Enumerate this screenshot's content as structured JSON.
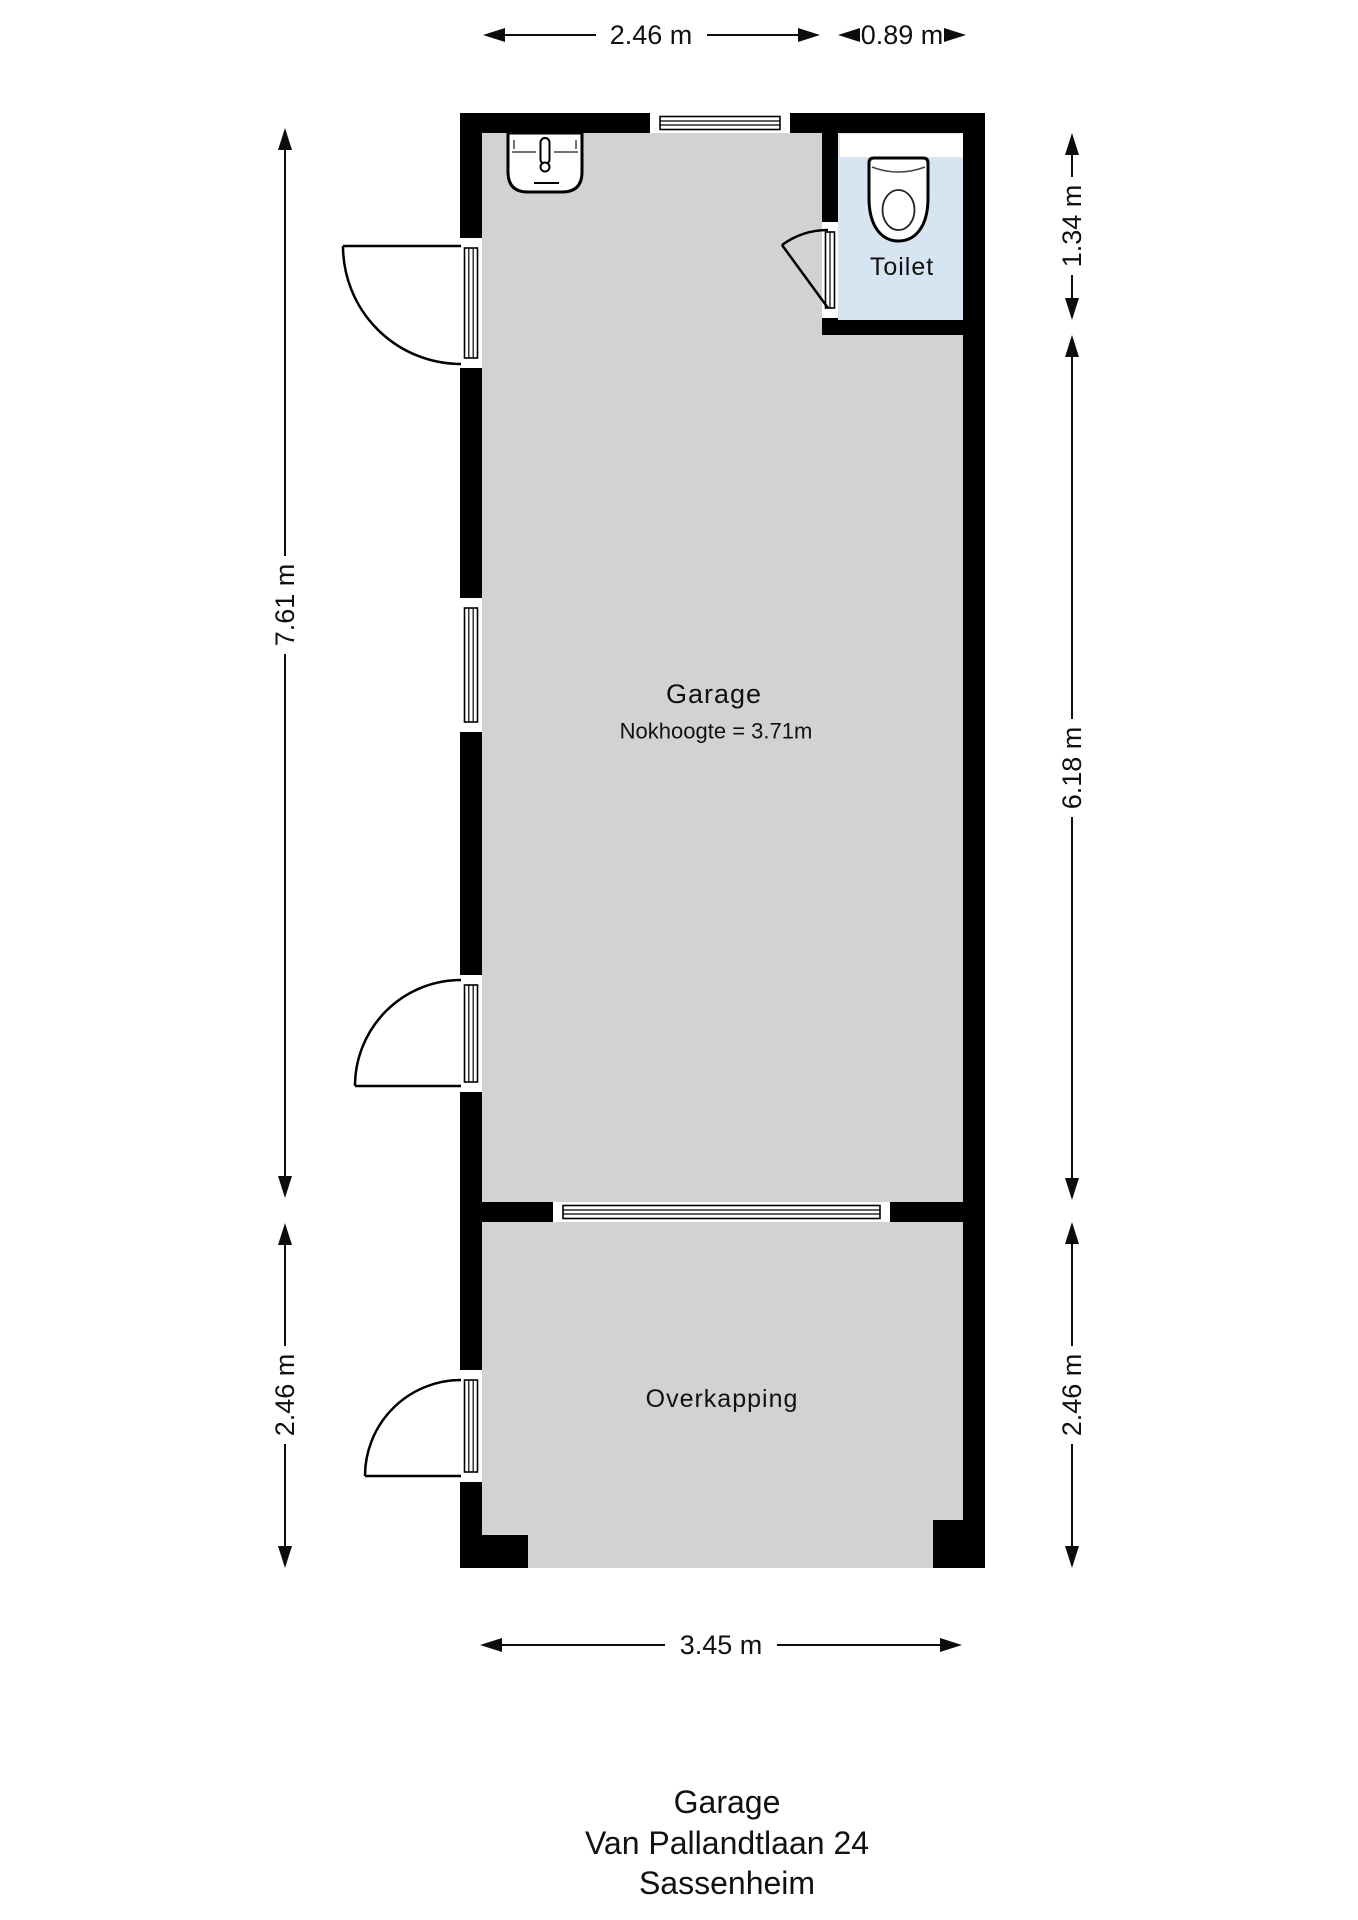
{
  "plan_title": {
    "line1": "Garage",
    "line2": "Van Pallandtlaan 24",
    "line3": "Sassenheim"
  },
  "rooms": {
    "garage": {
      "label": "Garage",
      "note": "Nokhoogte = 3.71m"
    },
    "toilet": {
      "label": "Toilet"
    },
    "overkapping": {
      "label": "Overkapping"
    }
  },
  "dimensions": {
    "top_garage_width": "2.46 m",
    "top_toilet_width": "0.89 m",
    "left_garage_height": "7.61 m",
    "left_overkapping_height": "2.46 m",
    "right_toilet_height": "1.34 m",
    "right_garage_height": "6.18 m",
    "right_overkapping_height": "2.46 m",
    "bottom_width": "3.45 m"
  },
  "colors": {
    "wall": "#000000",
    "floor": "#d2d2d2",
    "toilet_floor": "#d7e4f2",
    "white": "#ffffff"
  }
}
